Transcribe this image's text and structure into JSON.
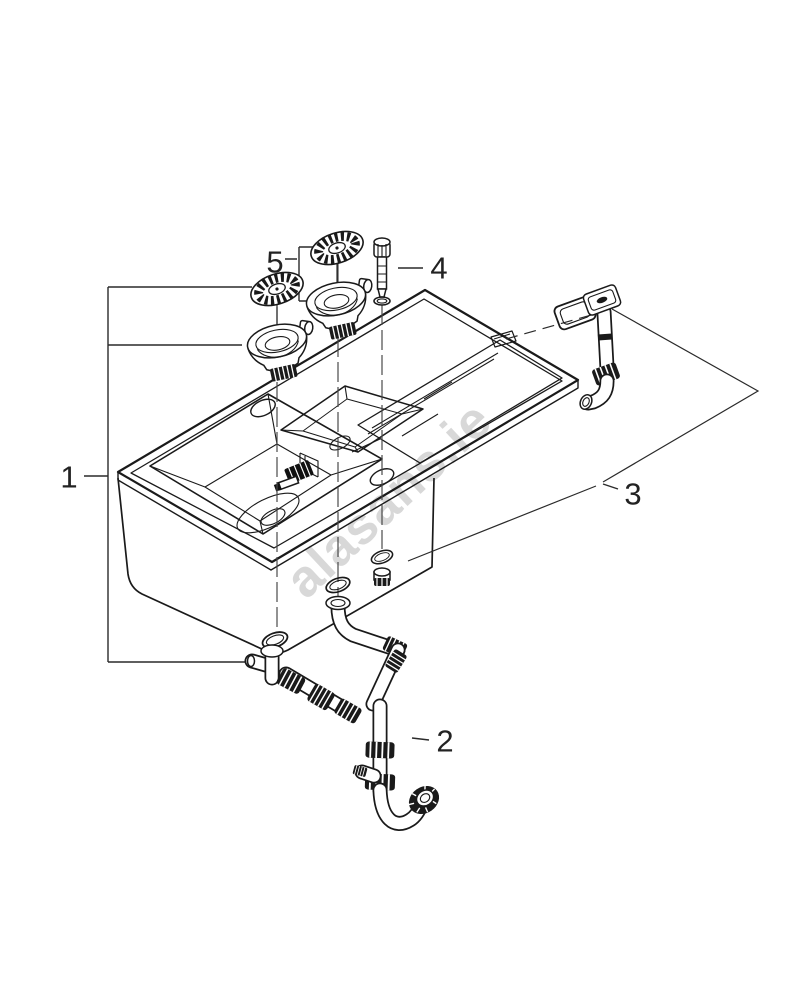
{
  "callouts": {
    "c1": "1",
    "c2": "2",
    "c3": "3",
    "c4": "4",
    "c5": "5"
  },
  "watermark": {
    "text": "alasans.ie",
    "color": "#d8d8d8"
  },
  "colors": {
    "line": "#1a1a1a",
    "leader": "#2a2a2a",
    "background": "#ffffff"
  }
}
